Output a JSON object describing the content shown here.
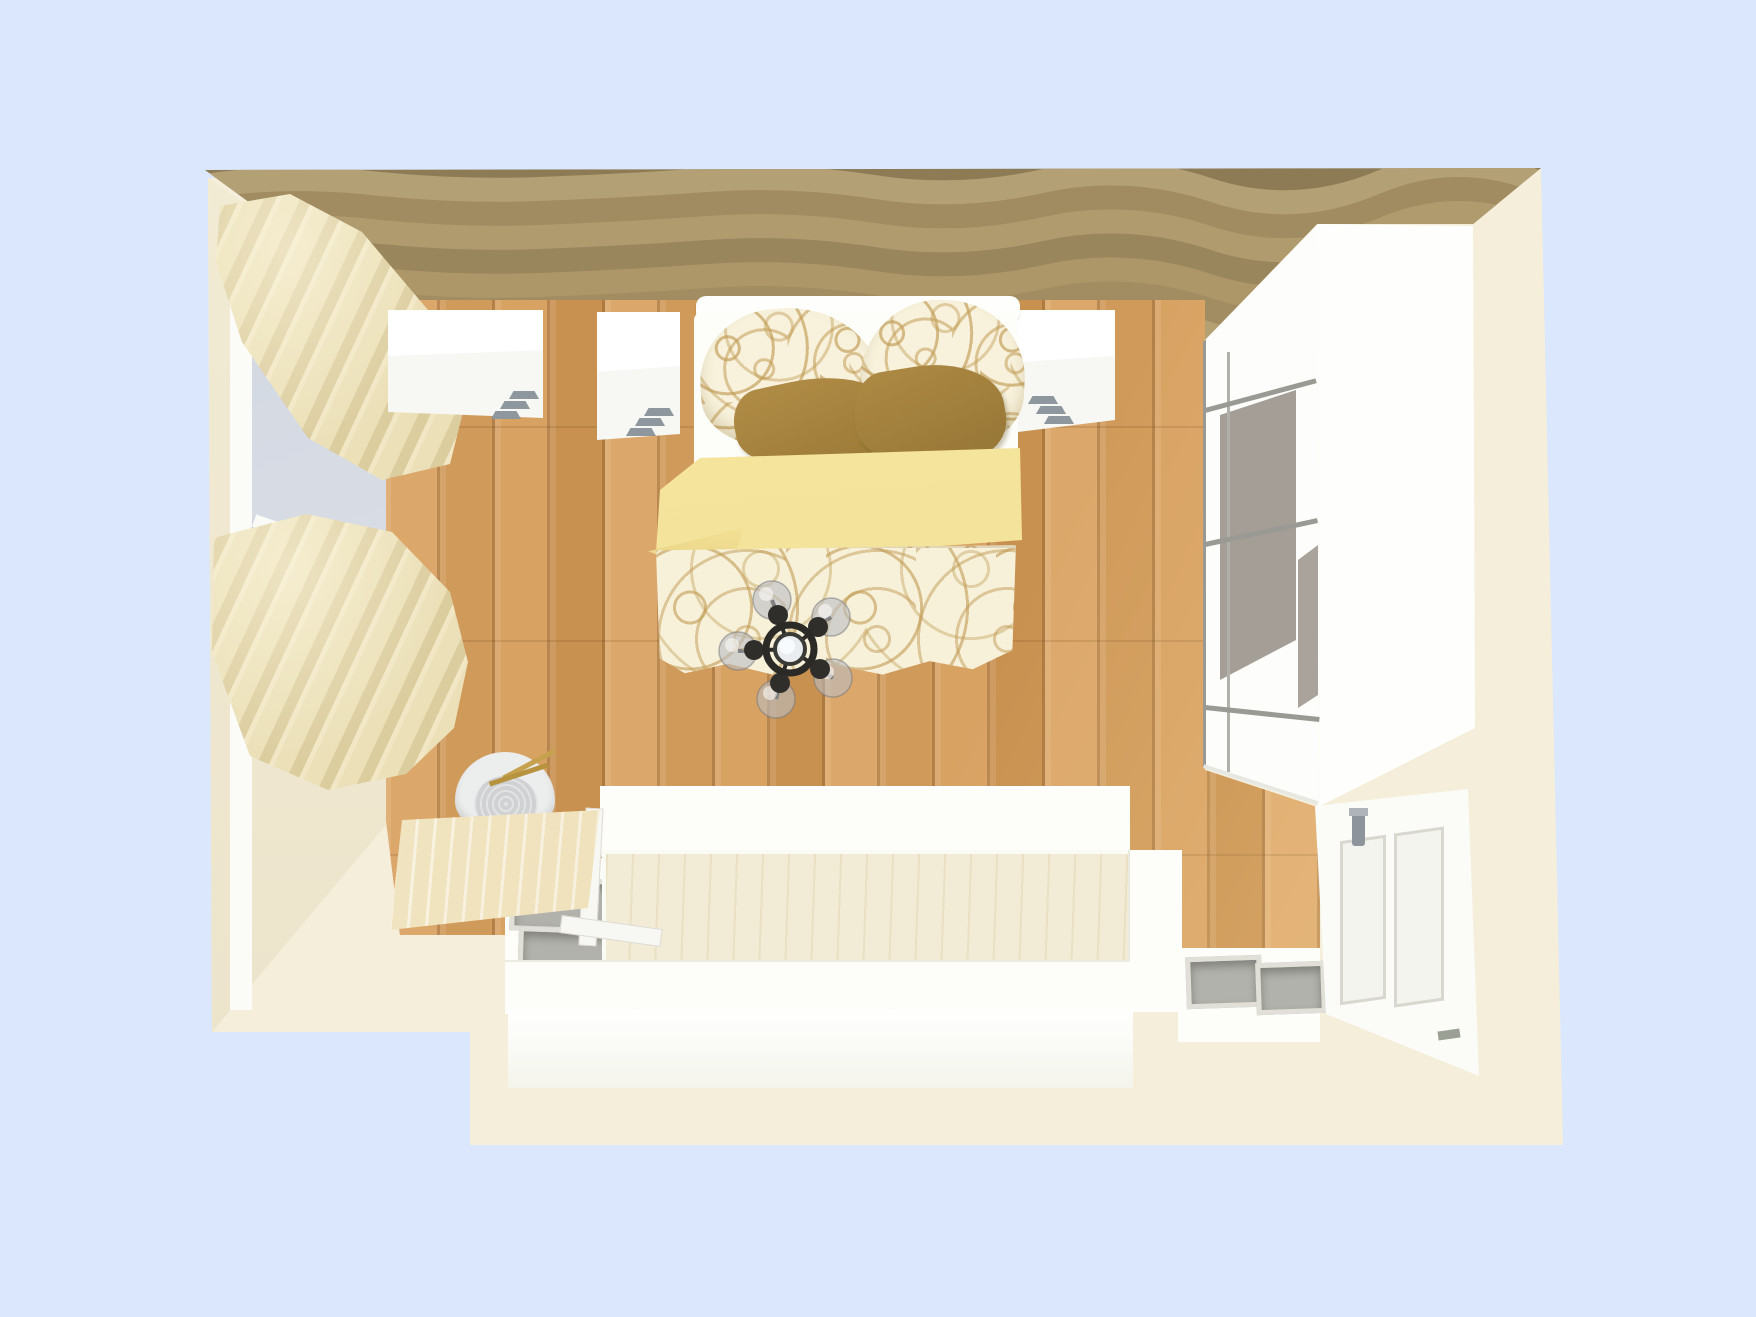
{
  "app": {
    "title": "3D Room Planner - Bedroom Top View",
    "viewport_mode": "perspective-top-down"
  },
  "palette": {
    "background_blue": "#dbe7fc",
    "wall_top_beige": "#f5eeda",
    "wall_cream": "#f0e9d2",
    "accent_wall_tan": "#a89365",
    "floor_oak": "#d09a5a",
    "curtain_cream": "#e8ddb3",
    "linen_swirl_tan": "#c19b54",
    "linen_base": "#f8f2dc",
    "cushion_gold": "#a8853f",
    "blanket_yellow": "#f6e59c",
    "furniture_white": "#fdfdfa",
    "wardrobe_panel_gray": "#a59e96",
    "metal_gray": "#8f979e",
    "light_fixture_black": "#2b2a26"
  },
  "objects": {
    "accentWall": {
      "label": "wave-textured accent wall"
    },
    "leftWall": {
      "label": "left wall with window"
    },
    "window": {
      "label": "window"
    },
    "curtainUpper": {
      "label": "curtain (upper)"
    },
    "curtainLower": {
      "label": "curtain (lower)"
    },
    "floor": {
      "label": "oak plank floor"
    },
    "dresserA": {
      "label": "white dresser A"
    },
    "dresserB": {
      "label": "white dresser B"
    },
    "nightstand": {
      "label": "white nightstand"
    },
    "bed": {
      "label": "double bed with patterned bedding"
    },
    "pillowLeft": {
      "label": "patterned pillow left"
    },
    "pillowRight": {
      "label": "patterned pillow right"
    },
    "cushionLeft": {
      "label": "gold cushion left"
    },
    "cushionRight": {
      "label": "gold cushion right"
    },
    "blanket": {
      "label": "yellow folded blanket"
    },
    "duvet": {
      "label": "swirl-patterned duvet"
    },
    "ceilingLight": {
      "label": "5-globe ceiling light"
    },
    "wardrobe": {
      "label": "sliding-door wardrobe"
    },
    "door": {
      "label": "white panel door"
    },
    "desk": {
      "label": "wooden desk"
    },
    "chair": {
      "label": "desk chair"
    },
    "platform": {
      "label": "white storage platform"
    },
    "storageBox": {
      "label": "open storage box"
    }
  }
}
